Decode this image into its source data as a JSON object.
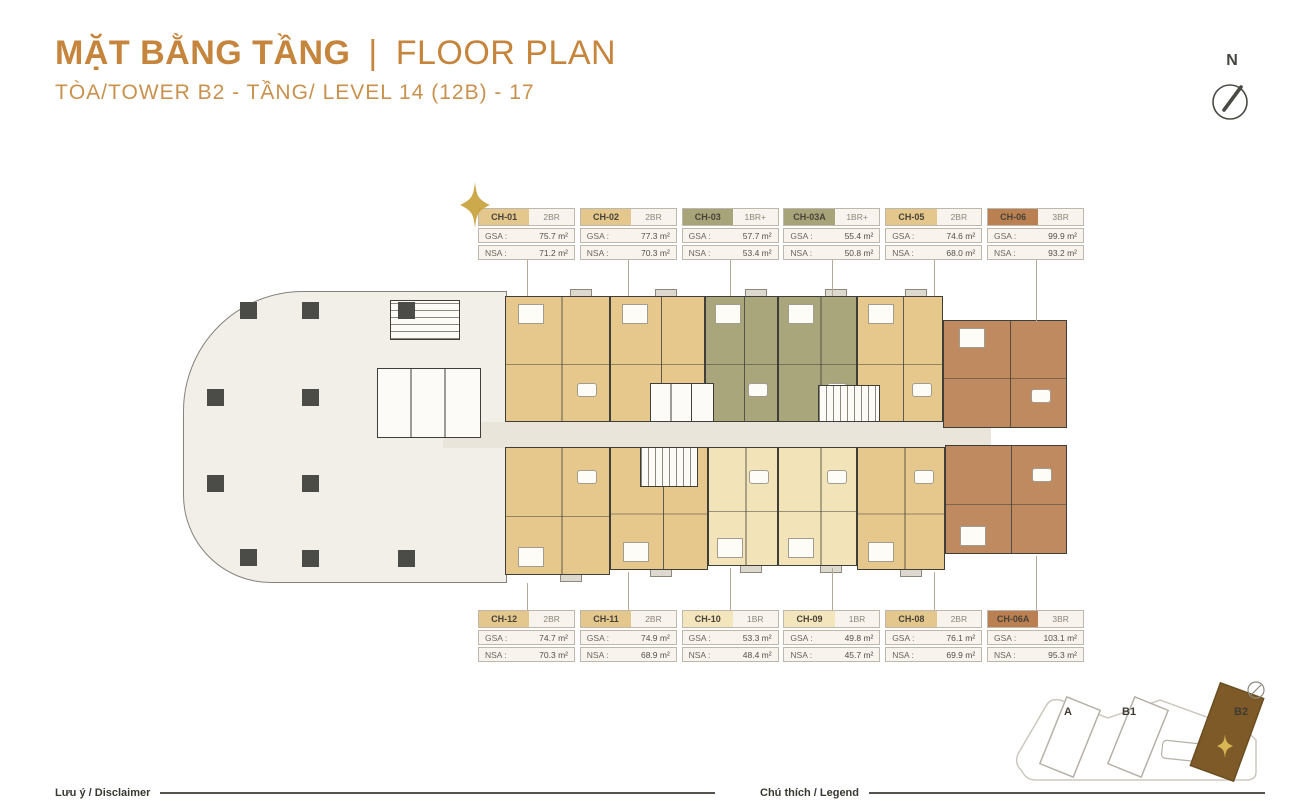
{
  "header": {
    "title_primary": "MẶT BẰNG TẦNG",
    "title_divider": "|",
    "title_secondary": "FLOOR PLAN",
    "subtitle": "TÒA/TOWER B2 - TẦNG/ LEVEL 14 (12B) - 17"
  },
  "compass": {
    "label": "N"
  },
  "labels": {
    "gsa": "GSA :",
    "nsa": "NSA :"
  },
  "palette": {
    "gold_title": "#C5853C",
    "tan": "#E6C88D",
    "cream": "#F2E4B8",
    "olive": "#AAA67C",
    "brown": "#BF8A5F",
    "card_tan": "#E3C78C",
    "card_cream": "#F4E6BC",
    "card_olive": "#A8A47A",
    "card_brown": "#BB8051",
    "podium": "#F1EFE7",
    "corridor": "#E9E5DA",
    "wall": "#3F3E39",
    "star_gold": "#C8A23B",
    "minimap_brown": "#7D5A28"
  },
  "unit_cards": {
    "top": [
      {
        "id": "CH-01",
        "type": "2BR",
        "gsa": "75.7 m²",
        "nsa": "71.2 m²",
        "color": "card_tan",
        "starred": true
      },
      {
        "id": "CH-02",
        "type": "2BR",
        "gsa": "77.3 m²",
        "nsa": "70.3 m²",
        "color": "card_tan"
      },
      {
        "id": "CH-03",
        "type": "1BR+",
        "gsa": "57.7 m²",
        "nsa": "53.4 m²",
        "color": "card_olive"
      },
      {
        "id": "CH-03A",
        "type": "1BR+",
        "gsa": "55.4 m²",
        "nsa": "50.8 m²",
        "color": "card_olive"
      },
      {
        "id": "CH-05",
        "type": "2BR",
        "gsa": "74.6 m²",
        "nsa": "68.0 m²",
        "color": "card_tan"
      },
      {
        "id": "CH-06",
        "type": "3BR",
        "gsa": "99.9 m²",
        "nsa": "93.2 m²",
        "color": "card_brown"
      }
    ],
    "bottom": [
      {
        "id": "CH-12",
        "type": "2BR",
        "gsa": "74.7 m²",
        "nsa": "70.3 m²",
        "color": "card_tan"
      },
      {
        "id": "CH-11",
        "type": "2BR",
        "gsa": "74.9 m²",
        "nsa": "68.9 m²",
        "color": "card_tan"
      },
      {
        "id": "CH-10",
        "type": "1BR",
        "gsa": "53.3 m²",
        "nsa": "48.4 m²",
        "color": "card_cream"
      },
      {
        "id": "CH-09",
        "type": "1BR",
        "gsa": "49.8 m²",
        "nsa": "45.7 m²",
        "color": "card_cream"
      },
      {
        "id": "CH-08",
        "type": "2BR",
        "gsa": "76.1 m²",
        "nsa": "69.9 m²",
        "color": "card_tan"
      },
      {
        "id": "CH-06A",
        "type": "3BR",
        "gsa": "103.1 m²",
        "nsa": "95.3 m²",
        "color": "card_brown"
      }
    ]
  },
  "minimap": {
    "towers": [
      {
        "label": "A",
        "highlighted": false
      },
      {
        "label": "B1",
        "highlighted": false
      },
      {
        "label": "B2",
        "highlighted": true
      }
    ]
  },
  "footer": {
    "disclaimer": "Lưu ý / Disclaimer",
    "legend": "Chú thích / Legend"
  }
}
